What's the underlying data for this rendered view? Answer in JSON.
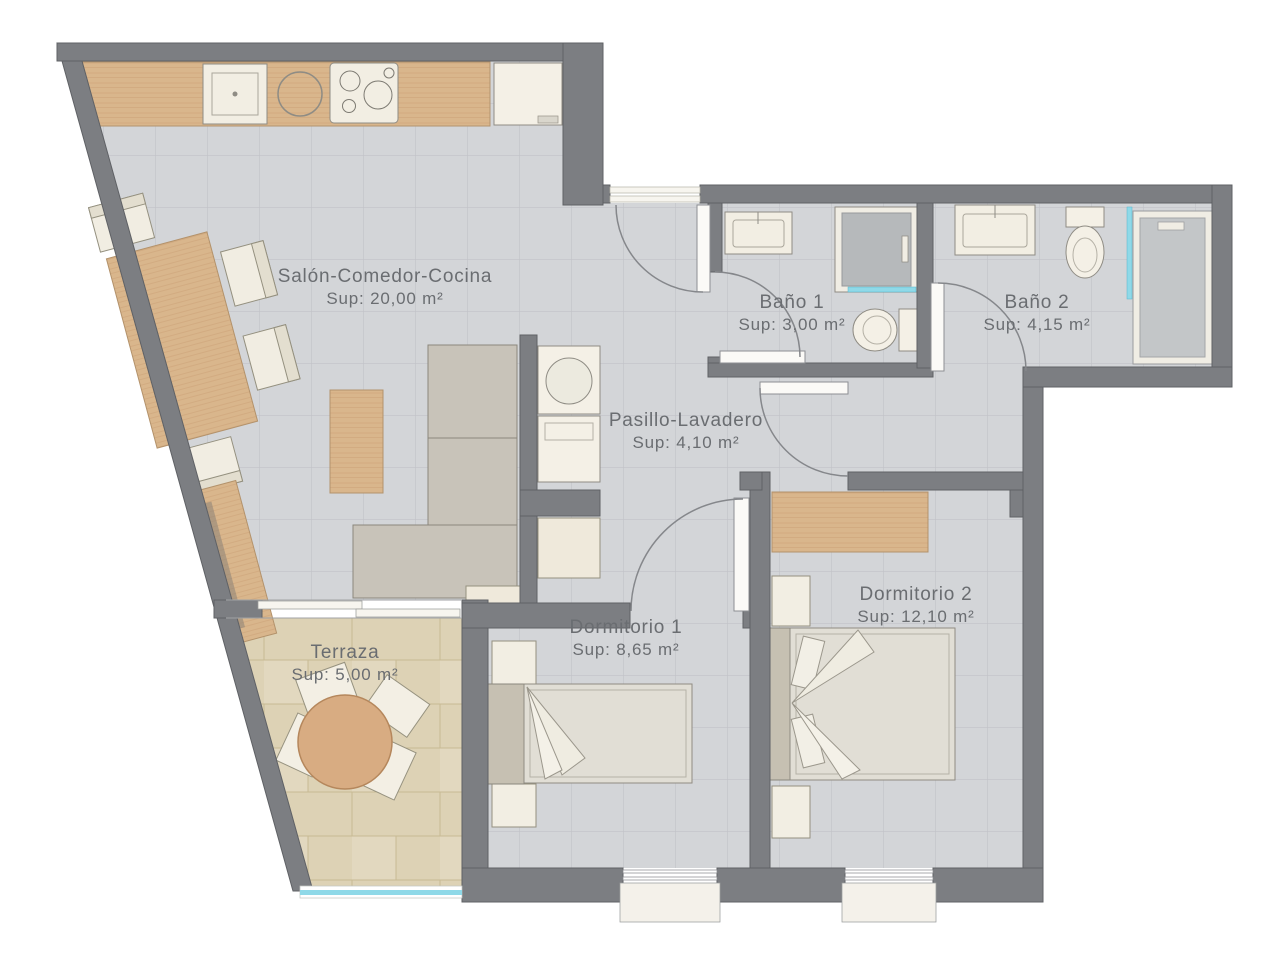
{
  "document": {
    "type": "floor-plan"
  },
  "rooms": [
    {
      "id": "salon",
      "label": "Salón-Comedor-Cocina",
      "area": "Sup: 20,00 m²"
    },
    {
      "id": "bano1",
      "label": "Baño 1",
      "area": "Sup: 3,00 m²"
    },
    {
      "id": "bano2",
      "label": "Baño 2",
      "area": "Sup: 4,15 m²"
    },
    {
      "id": "pasillo",
      "label": "Pasillo-Lavadero",
      "area": "Sup: 4,10 m²"
    },
    {
      "id": "dormitorio1",
      "label": "Dormitorio 1",
      "area": "Sup: 8,65 m²"
    },
    {
      "id": "dormitorio2",
      "label": "Dormitorio 2",
      "area": "Sup: 12,10 m²"
    },
    {
      "id": "terraza",
      "label": "Terraza",
      "area": "Sup: 5,00 m²"
    }
  ],
  "colors": {
    "wall": "#7c7e82",
    "floor_tile": "#d3d5d8",
    "terrace_tile": "#e0d5ba",
    "wood": "#d9b68c",
    "fixture_cream": "#f2eee3",
    "appliance_gray": "#bcbfc1",
    "glass_blue": "#8fd9e8",
    "label_text": "#6a6d71"
  }
}
